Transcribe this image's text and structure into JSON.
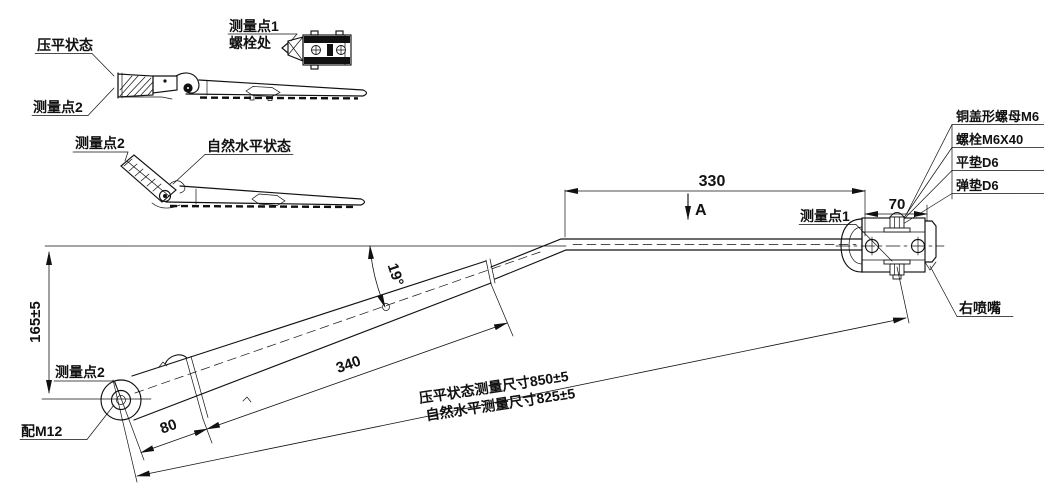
{
  "colors": {
    "ink": "#111111",
    "background": "#ffffff"
  },
  "views": {
    "flat": {
      "state": "压平状态",
      "point2": "测量点2"
    },
    "bolt_detail": {
      "point1": "测量点1",
      "location": "螺栓处"
    },
    "natural": {
      "point2": "测量点2",
      "state": "自然水平状态"
    }
  },
  "parts_list": [
    "铜盖形螺母M6",
    "螺栓M6X40",
    "平垫D6",
    "弹垫D6"
  ],
  "main": {
    "point1": "测量点1",
    "point2": "测量点2",
    "pivot_fit": "配M12",
    "nozzle": "右喷嘴",
    "section_marker": "A",
    "dims": {
      "rod_length": "330",
      "nozzle_offset": "70",
      "bend_angle": "19°",
      "arm_length": "340",
      "head_length": "80",
      "height": "165±5",
      "flat_total": "压平状态测量尺寸850±5",
      "natural_total": "自然水平测量尺寸825±5"
    }
  }
}
